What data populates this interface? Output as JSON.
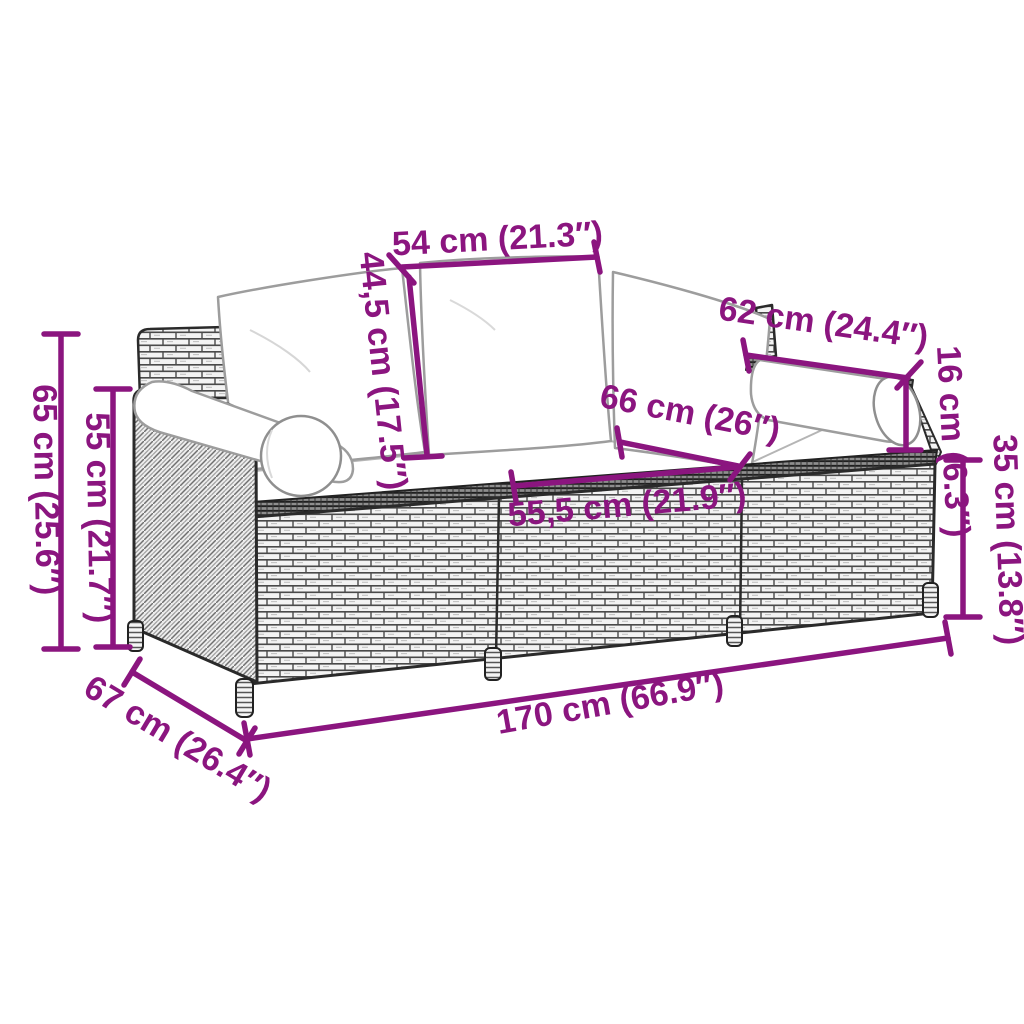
{
  "diagram": {
    "type": "product-dimension-diagram",
    "subject": "3-seater rattan garden sofa with cushions and bolster pillows",
    "accent_color": "#8B157F",
    "background_color": "#FFFFFF",
    "dimensions": [
      {
        "id": "back-cushion-width",
        "label": "54 cm (21.3″)"
      },
      {
        "id": "back-cushion-height",
        "label": "44,5 cm (17.5″)"
      },
      {
        "id": "bolster-length",
        "label": "62 cm (24.4″)"
      },
      {
        "id": "bolster-diameter",
        "label": "16 cm (6.3″)"
      },
      {
        "id": "seat-depth",
        "label": "66 cm (26″)"
      },
      {
        "id": "seat-width",
        "label": "55,5 cm (21.9″)"
      },
      {
        "id": "seat-height",
        "label": "35 cm (13.8″)"
      },
      {
        "id": "total-height",
        "label": "65 cm (25.6″)"
      },
      {
        "id": "armrest-height",
        "label": "55 cm (21.7″)"
      },
      {
        "id": "total-depth",
        "label": "67 cm (26.4″)"
      },
      {
        "id": "total-length",
        "label": "170 cm (66.9″)"
      }
    ]
  }
}
